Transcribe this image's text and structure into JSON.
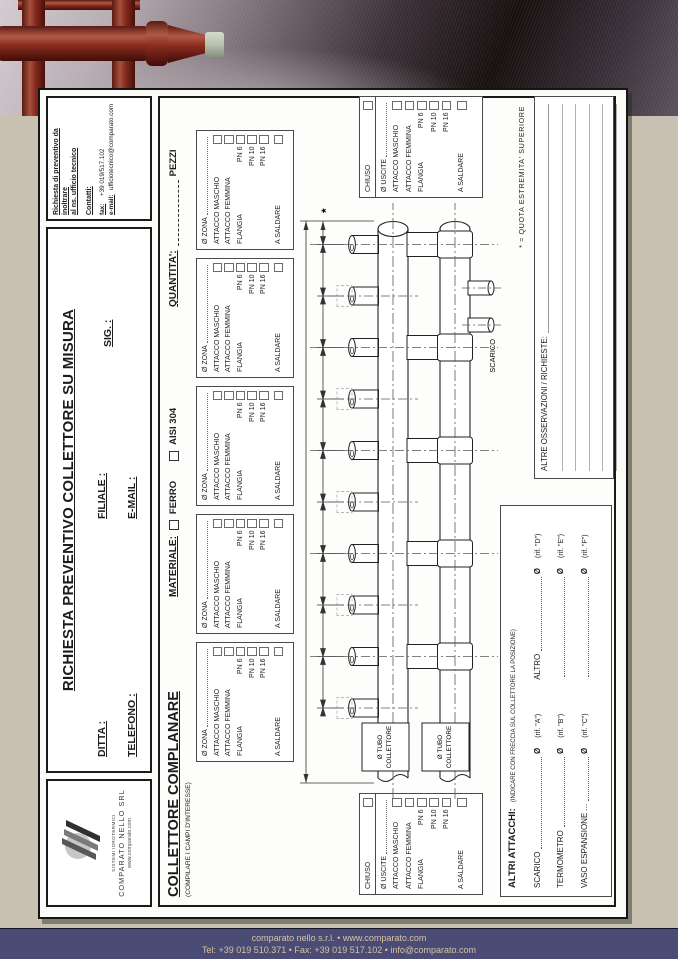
{
  "header": {
    "title": "RICHIESTA PREVENTIVO COLLETTORE SU MISURA",
    "ditta": "DITTA :",
    "filiale": "FILIALE :",
    "sig": "SIG. :",
    "telefono": "TELEFONO :",
    "email": "E-MAIL :"
  },
  "contact": {
    "line1": "Richiesta di preventivo da inoltrare",
    "line2": "al ns. ufficio tecnico",
    "contatti": "Contatti:",
    "fax_label": "fax:",
    "fax": "+39 019/517.102",
    "email_label": "e-mail:",
    "email": "ufficiotecnico@comparato.com"
  },
  "logo": {
    "tagline": "SISTEMI IDROTERMICI",
    "company": "COMPARATO NELLO SRL",
    "website": "www.comparato.com"
  },
  "main": {
    "section_title": "COLLETTORE COMPLANARE",
    "section_subtitle": "(COMPILARE I CAMPI D'INTERESSE)",
    "materiale_label": "MATERIALE:",
    "materiale_options": [
      "FERRO",
      "AISI 304"
    ],
    "quantita_label": "QUANTITA':",
    "pezzi_label": "PEZZI",
    "zone_box": {
      "zona": "Ø ZONA",
      "maschio": "ATTACCO MASCHIO",
      "femmina": "ATTACCO FEMMINA",
      "flangia": "FLANGIA",
      "pn6": "PN 6",
      "pn10": "PN 10",
      "pn16": "PN 16",
      "saldare": "A SALDARE"
    },
    "end_box": {
      "chiuso": "CHIUSO",
      "uscite": "Ø USCITE",
      "maschio": "ATTACCO MASCHIO",
      "femmina": "ATTACCO FEMMINA",
      "flangia": "FLANGIA",
      "pn6": "PN 6",
      "pn10": "PN 10",
      "pn16": "PN 16",
      "saldare": "A SALDARE"
    },
    "drawing": {
      "scarico": "SCARICO",
      "tube_label_1": "Ø TUBO",
      "tube_label_2": "COLLETTORE",
      "asterisk": "*"
    },
    "quota_note": "* = QUOTA  ESTREMITA'  SUPERIORE",
    "osservazioni_label": "ALTRE OSSERVAZIONI / RICHIESTE:",
    "altri": {
      "title": "ALTRI ATTACCHI:",
      "note": "(INDICARE CON FRECCIA SUL COLLETTORE LA POSIZIONE)",
      "dia": "Ø",
      "rows": [
        {
          "l": "SCARICO",
          "rif": "(rif. \"A\")",
          "l2": "ALTRO",
          "rif2": "(rif. \"D\")"
        },
        {
          "l": "TERMOMETRO",
          "rif": "(rif. \"B\")",
          "l2": "",
          "rif2": "(rif. \"E\")"
        },
        {
          "l": "VASO ESPANSIONE ...",
          "rif": "(rif. \"C\")",
          "l2": "",
          "rif2": "(rif. \"F\")"
        }
      ]
    }
  },
  "footer": {
    "line1": "comparato nello s.r.l. • www.comparato.com",
    "line2": "Tel: +39 019 510.371 • Fax: +39 019 517.102 • info@comparato.com"
  },
  "colors": {
    "pipe_red": "#8c2f23",
    "cap_green": "#b7c2b0",
    "footer_bar": "#4a4c76",
    "background": "#c8c1b2"
  }
}
